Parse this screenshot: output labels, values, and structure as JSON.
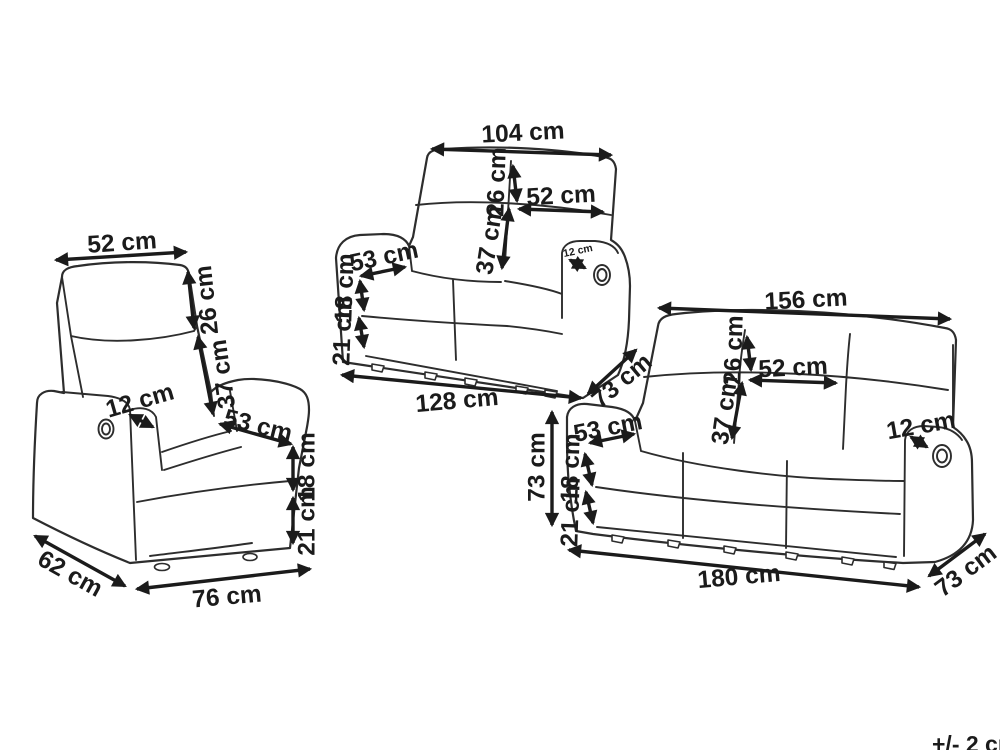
{
  "diagram": {
    "tolerance_note": "+/- 2 cm",
    "armchair": {
      "back_width": "52 cm",
      "headrest_height": "26 cm",
      "backrest_height": "37 cm",
      "armrest_width": "12 cm",
      "seat_depth": "53 cm",
      "seat_height": "18 cm",
      "base_height": "21 cm",
      "depth": "62 cm",
      "width": "76 cm"
    },
    "two_seater": {
      "back_width": "104 cm",
      "headrest_height": "26 cm",
      "seat_width": "52 cm",
      "backrest_height": "37 cm",
      "seat_depth": "53 cm",
      "armrest_width": "12 cm",
      "seat_height": "18 cm",
      "base_height": "21 cm",
      "width": "128 cm",
      "depth": "73 cm"
    },
    "three_seater": {
      "back_width": "156 cm",
      "headrest_height": "26 cm",
      "seat_width": "52 cm",
      "backrest_height": "37 cm",
      "seat_depth": "53 cm",
      "armrest_width": "12 cm",
      "height": "73 cm",
      "seat_height": "18 cm",
      "base_height": "21 cm",
      "width": "180 cm",
      "depth": "73 cm"
    }
  }
}
